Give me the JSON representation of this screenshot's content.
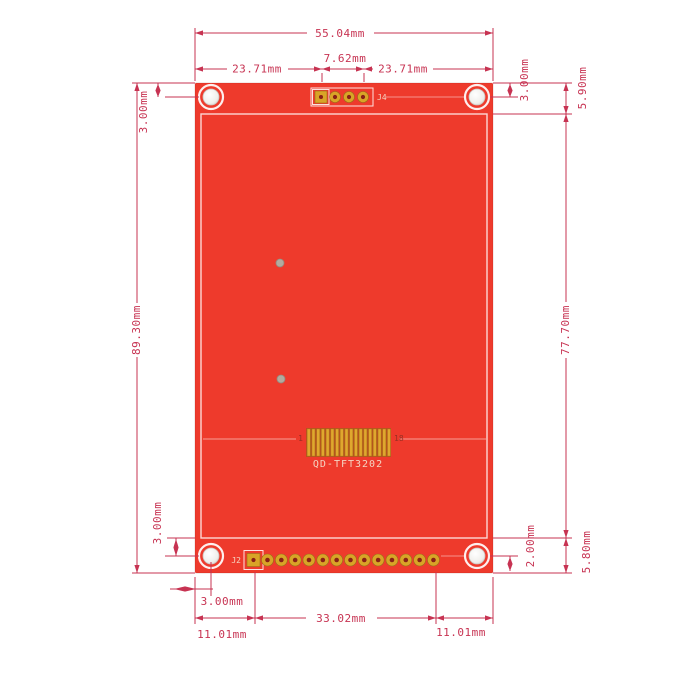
{
  "drawing": {
    "title": "PCB dimension drawing",
    "units": "mm"
  },
  "dims": {
    "overall_width": "55.04mm",
    "top_left_span": "23.71mm",
    "top_center_span": "7.62mm",
    "top_right_span": "23.71mm",
    "hole_offset_top_left": "3.00mm",
    "hole_offset_top_right": "3.00mm",
    "top_margin_right": "5.90mm",
    "overall_height": "89.30mm",
    "display_height": "77.70mm",
    "hole_offset_bottom_left": "3.00mm",
    "bottom_gap_right": "2.00mm",
    "bottom_margin_right": "5.80mm",
    "hole_offset_bottom_h": "3.00mm",
    "bottom_left_span": "11.01mm",
    "bottom_center_span": "33.02mm",
    "bottom_right_span": "11.01mm"
  },
  "board": {
    "model": "QD-TFT3202",
    "top_connector_label": "J4",
    "bottom_connector_label": "J2",
    "fpc_first_pin": "1",
    "fpc_last_pin": "18"
  },
  "colors": {
    "pcb_red": "#ee3a2c",
    "dimension_red": "#c73352",
    "pad_gold": "#d9a427",
    "silkscreen": "#ffffff"
  }
}
